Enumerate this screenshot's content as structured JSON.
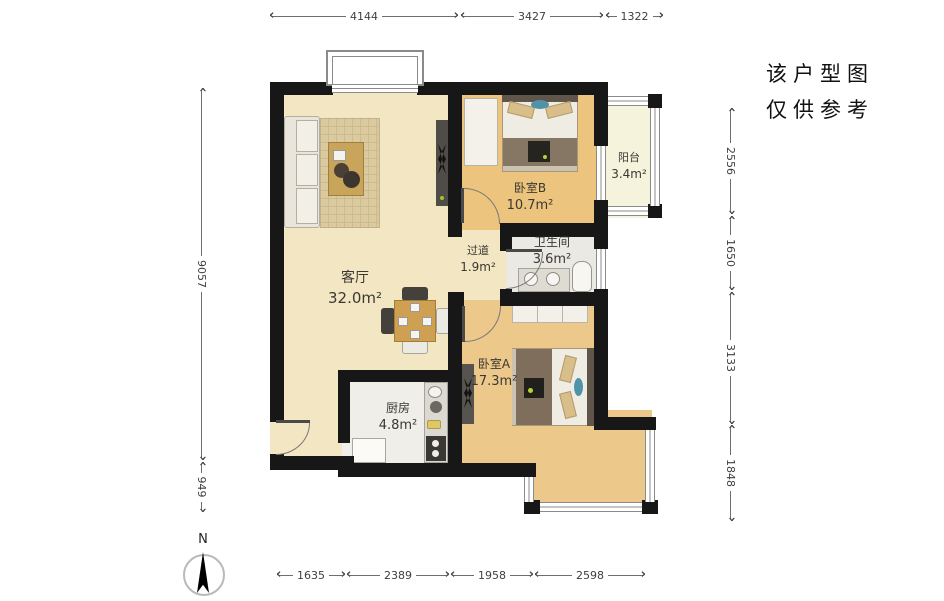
{
  "note": {
    "line1": "该户型图",
    "line2": "仅供参考"
  },
  "compass": {
    "north_label": "N"
  },
  "rooms": {
    "living": {
      "name": "客厅",
      "area": "32.0m²"
    },
    "hallway": {
      "name": "过道",
      "area": "1.9m²"
    },
    "bedroom_b": {
      "name": "卧室B",
      "area": "10.7m²"
    },
    "balcony": {
      "name": "阳台",
      "area": "3.4m²"
    },
    "bathroom": {
      "name": "卫生间",
      "area": "3.6m²"
    },
    "bedroom_a": {
      "name": "卧室A",
      "area": "17.3m²"
    },
    "kitchen": {
      "name": "厨房",
      "area": "4.8m²"
    }
  },
  "dimensions_mm": {
    "top": [
      "4144",
      "3427",
      "1322"
    ],
    "bottom": [
      "1635",
      "2389",
      "1958",
      "2598"
    ],
    "left": [
      "9057",
      "949"
    ],
    "right": [
      "2556",
      "1650",
      "3133",
      "1848"
    ]
  },
  "colors": {
    "wall": "#171717",
    "living_floor": "#f2e7c2",
    "wood_floor": "#ecc47e",
    "balcony_floor": "#f6f3dc",
    "wet_floor": "#eae9e4",
    "accent_teal": "#4e93a8"
  }
}
